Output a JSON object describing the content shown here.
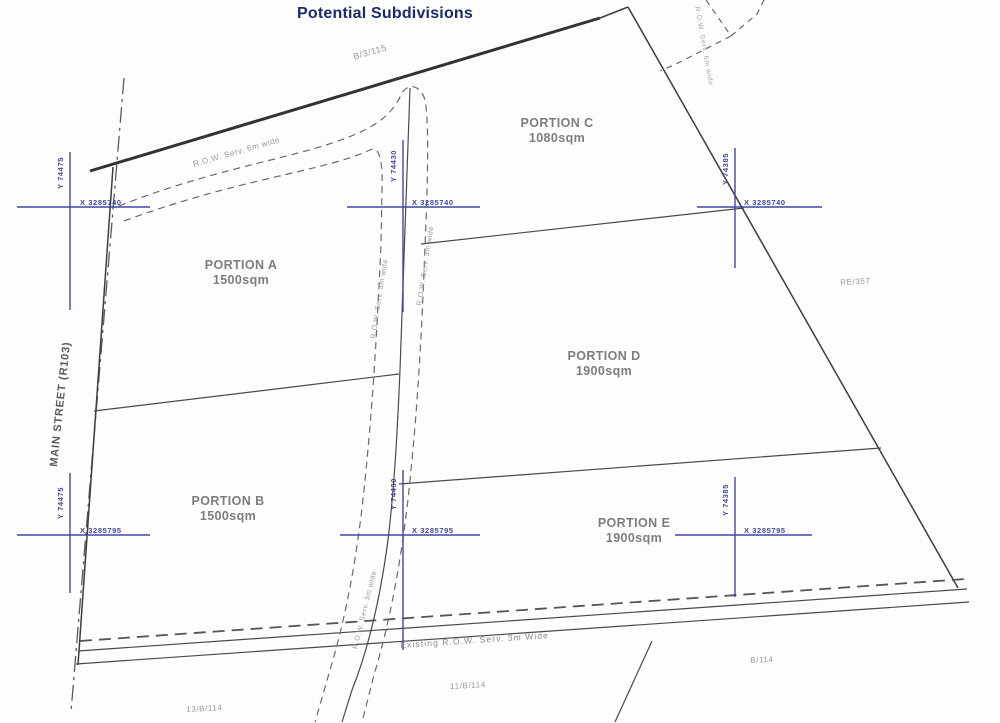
{
  "title": "Potential Subdivisions",
  "colors": {
    "title": "#1b2a6b",
    "boundary": "#3d3d3d",
    "internal_line": "#4a4a4a",
    "servitude_dash": "#6a6a6a",
    "coordinate_cross": "#4146a5",
    "label_gray": "#7d7d7d"
  },
  "street": {
    "label": "MAIN STREET (R103)"
  },
  "portions": [
    {
      "name": "PORTION A",
      "area": "1500sqm"
    },
    {
      "name": "PORTION B",
      "area": "1500sqm"
    },
    {
      "name": "PORTION C",
      "area": "1080sqm"
    },
    {
      "name": "PORTION D",
      "area": "1900sqm"
    },
    {
      "name": "PORTION E",
      "area": "1900sqm"
    }
  ],
  "crosses": [
    {
      "y_label": "Y 74475",
      "x_label": "X 3285740"
    },
    {
      "y_label": "Y 74430",
      "x_label": "X 3285740"
    },
    {
      "y_label": "Y 74385",
      "x_label": "X 3285740"
    },
    {
      "y_label": "Y 74475",
      "x_label": "X 3285795"
    },
    {
      "y_label": "Y 74430",
      "x_label": "X 3285795"
    },
    {
      "y_label": "Y 74385",
      "x_label": "X 3285795"
    }
  ],
  "annotations": {
    "erf_top": "B/3/115",
    "row_6m": "R.O.W. Serv. 6m wide",
    "row_pocket": "R.O.W. Serv. 6m wide",
    "row_3m_left": "R.O.W. Serv. 3m wide",
    "row_3m_right": "R.O.W. Serv. 3m wide",
    "row_3m_lower": "R.O.W. Serv. 3m wide",
    "re_357": "RE/357",
    "existing_row": "Existing R.O.W. Serv. 3m Wide",
    "b_114": "B/114",
    "erf_11": "11/B/114",
    "erf_13": "13/B/114"
  }
}
